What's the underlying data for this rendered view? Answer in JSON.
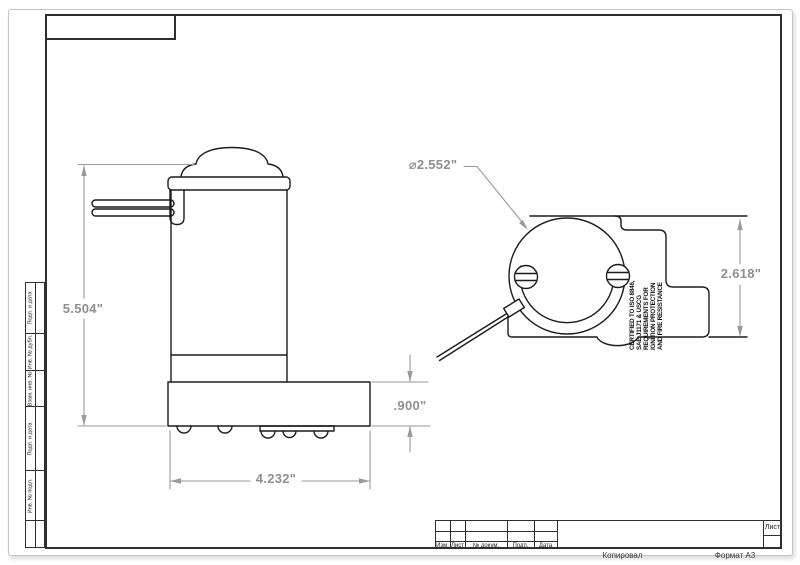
{
  "sheet": {
    "sheet_label": "Лист",
    "copied_label": "Копировал",
    "format_label": "Формат А3",
    "title_block_columns": [
      "Изм.",
      "Лист",
      "№ докум.",
      "Подп.",
      "Дата"
    ],
    "margin_labels": [
      "Подп. и дата",
      "Инв. № дубл.",
      "Взам. инв. №",
      "Подп. и дата",
      "Инв. № подл."
    ]
  },
  "part": {
    "side_view": {
      "overall_height": "5.504\"",
      "base_width": "4.232\"",
      "base_height": ".900\""
    },
    "end_view": {
      "diameter": "⌀2.552\"",
      "overall_height": "2.618\"",
      "certification_lines": [
        "CERTIFIED TO ISO 8846,",
        "SAE J1171 & USCG",
        "REQUIREMENTS FOR",
        "IGNITION PROTECTION",
        "AND FIRE RESISTANCE"
      ]
    }
  }
}
